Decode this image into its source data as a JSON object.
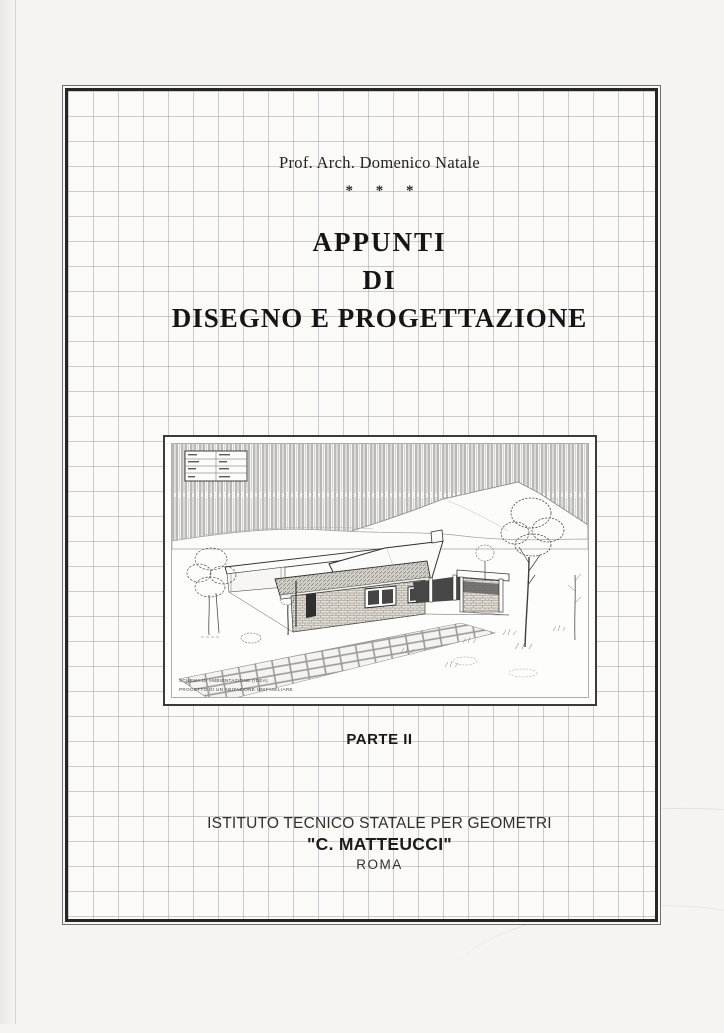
{
  "cover": {
    "author_line": "Prof. Arch. Domenico Natale",
    "separator": "* * *",
    "title_line1": "APPUNTI",
    "title_line2": "DI",
    "title_line3": "DISEGNO E PROGETTAZIONE",
    "part_label": "PARTE II",
    "institution_line1": "ISTITUTO TECNICO STATALE PER GEOMETRI",
    "institution_line2": "\"C. MATTEUCCI\"",
    "institution_line3": "ROMA",
    "illustration": {
      "alt": "pencil perspective sketch of a single-storey house with fence, mountains, trees and paved walkway",
      "caption_line1": "SCHEMA DI AMBIENTAZIONE (IDEA)",
      "caption_line2": "PROGETTO DI UN ABITAZIONE UNIFAMILIARE"
    },
    "colors": {
      "paper": "#f5f4f1",
      "grid_paper": "#fbfaf7",
      "grid_line": "#b6bac2",
      "ink": "#1d1d1d",
      "frame_dark": "#262626",
      "frame_light": "#6f6f6f"
    }
  }
}
